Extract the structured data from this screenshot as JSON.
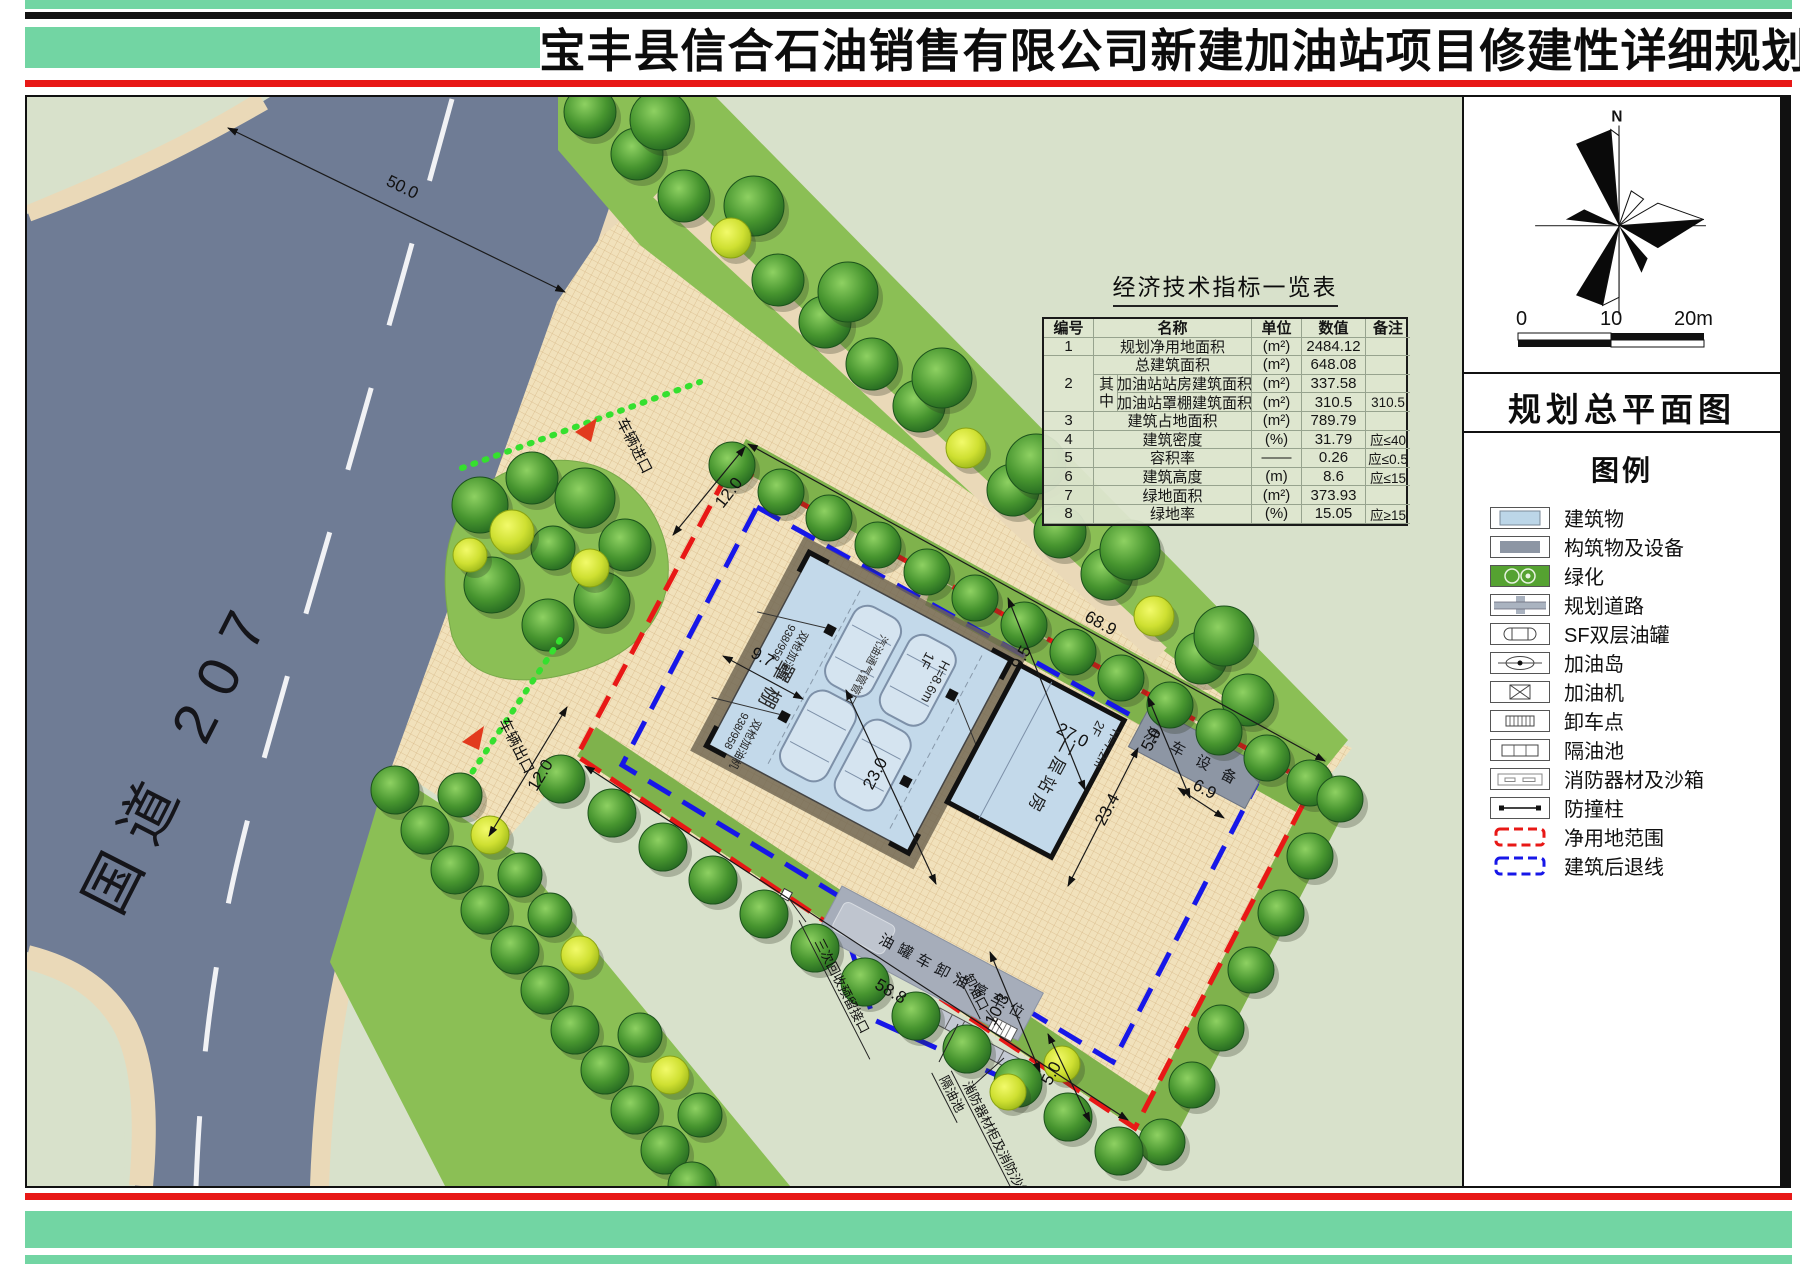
{
  "title": "宝丰县信合石油销售有限公司新建加油站项目修建性详细规划",
  "sidebar": {
    "north": "N",
    "scale_ticks": [
      "0",
      "10",
      "20m"
    ],
    "plan_title": "规划总平面图",
    "legend_title": "图例",
    "legend": [
      {
        "label": "建筑物"
      },
      {
        "label": "构筑物及设备"
      },
      {
        "label": "绿化"
      },
      {
        "label": "规划道路"
      },
      {
        "label": "SF双层油罐"
      },
      {
        "label": "加油岛"
      },
      {
        "label": "加油机"
      },
      {
        "label": "卸车点"
      },
      {
        "label": "隔油池"
      },
      {
        "label": "消防器材及沙箱"
      },
      {
        "label": "防撞柱"
      },
      {
        "label": "净用地范围"
      },
      {
        "label": "建筑后退线"
      }
    ]
  },
  "table": {
    "title": "经济技术指标一览表",
    "headers": [
      "编号",
      "名称",
      "单位",
      "数值",
      "备注"
    ],
    "rows": {
      "r1": {
        "no": "1",
        "name": "规划净用地面积",
        "unit": "(m²)",
        "value": "2484.12",
        "note": ""
      },
      "r2": {
        "no": "2",
        "name": "总建筑面积",
        "unit": "(m²)",
        "value": "648.08",
        "note": "",
        "group": "其中",
        "sub1": {
          "name": "加油站站房建筑面积",
          "unit": "(m²)",
          "value": "337.58",
          "note": ""
        },
        "sub2": {
          "name": "加油站罩棚建筑面积",
          "unit": "(m²)",
          "value": "310.5",
          "note": "310.5"
        }
      },
      "r3": {
        "no": "3",
        "name": "建筑占地面积",
        "unit": "(m²)",
        "value": "789.79",
        "note": ""
      },
      "r4": {
        "no": "4",
        "name": "建筑密度",
        "unit": "(%)",
        "value": "31.79",
        "note": "应≤40"
      },
      "r5": {
        "no": "5",
        "name": "容积率",
        "unit": "——",
        "value": "0.26",
        "note": "应≤0.5"
      },
      "r6": {
        "no": "6",
        "name": "建筑高度",
        "unit": "(m)",
        "value": "8.6",
        "note": "应≤15"
      },
      "r7": {
        "no": "7",
        "name": "绿地面积",
        "unit": "(m²)",
        "value": "373.93",
        "note": ""
      },
      "r8": {
        "no": "8",
        "name": "绿地率",
        "unit": "(%)",
        "value": "15.05",
        "note": "应≥15"
      }
    }
  },
  "plan": {
    "road_label": "国道 207",
    "dims": {
      "d50": "50.0",
      "d12a": "12.0",
      "d12b": "12.0",
      "d9_7": "9.7",
      "d68_9": "68.9",
      "d9_5": "9.5",
      "d27": "27.0",
      "d5a": "5.0",
      "d6_9": "6.9",
      "d23": "23.0",
      "d23_4": "23.4",
      "d58_8": "58.8",
      "d10_3": "10.3",
      "d5b": "5.0"
    },
    "labels": {
      "canopy": "罩棚",
      "canopy_floor": "1F",
      "canopy_height": "H=8.6m",
      "station": "二层站房",
      "station_floor": "2F",
      "station_height": "H=7.2m",
      "carwash": "洗车设备",
      "parking": "停车位",
      "tanker": "油罐车卸油停车位",
      "unload": "卸油口",
      "recovery": "三次回收预留接口",
      "separator": "隔油池",
      "fire": "消防器材柜及消防沙箱",
      "vent": "汽油通气管管口",
      "dispenser": "双枪加油机",
      "dispenser_model": "938/958",
      "entry": "车辆进口",
      "exit": "车辆出口"
    }
  }
}
